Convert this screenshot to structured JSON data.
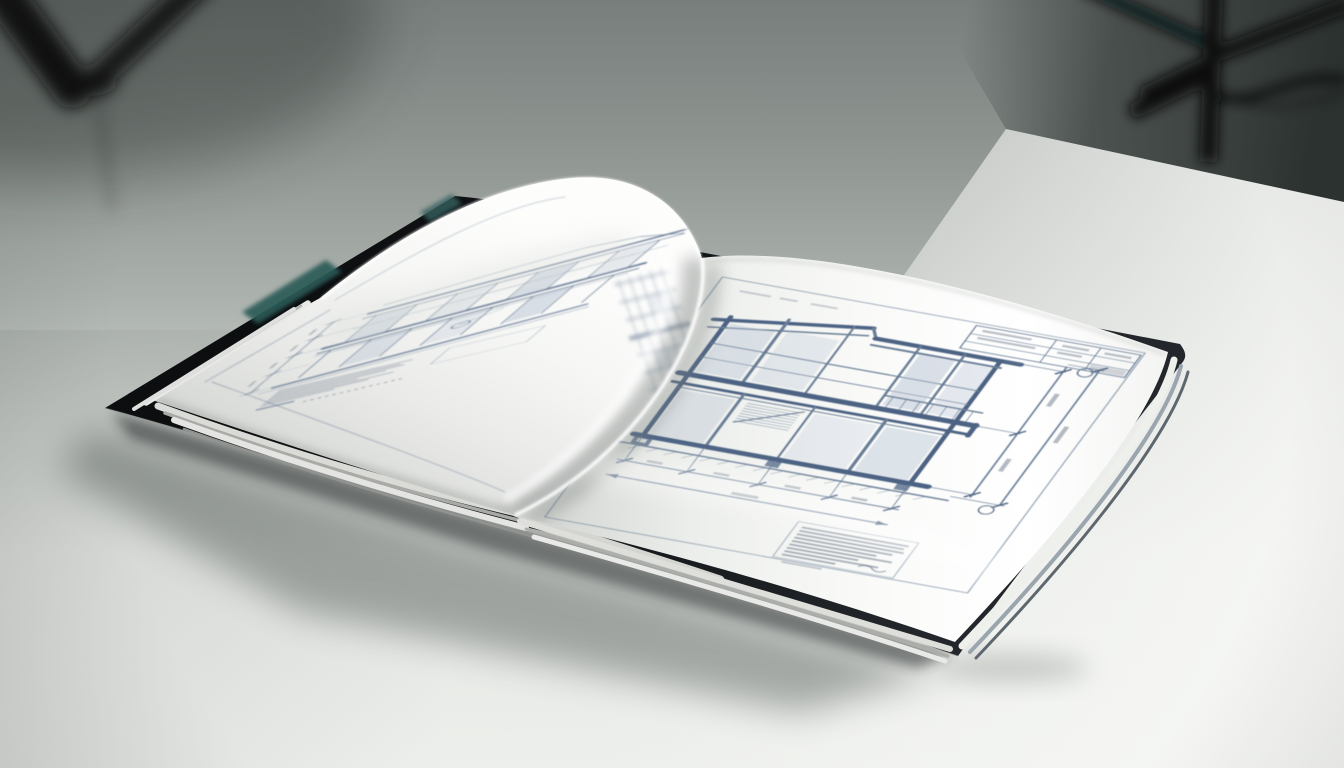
{
  "scene": {
    "type": "photograph",
    "description": "An open hardcover book of architectural blueprint drawings lies on a white studio table, with out-of-focus black tripod light stands against a gray backdrop",
    "background": {
      "backdrop": "seamless gray studio wall, darkest in the upper right corner",
      "tripod_left": "blurred black tripod legs entering the upper left corner",
      "light_stand_right": "blurred black light stand with bracket and trailing cable, upper right",
      "table": "white seamless table surface, brighter toward the lower right"
    },
    "book": {
      "cover": "charcoal-black hardcover, edges visible beyond the page stack",
      "cover_accent": "teal endpaper sliver visible along the upper-left cover edge",
      "pages": "thick white page stack, pages curled upward at the centre gutter",
      "left_page": "multi-storey building facade elevation with glazing grid, slab bands, dimension string and small annotation text (illegible)",
      "right_page": "two-storey building cross-section with floor slab, footings, vertical and horizontal dimension chains, title block and notes block (illegible)"
    },
    "shadow": "soft diffuse shadow cast to the lower left of the book"
  },
  "colors": {
    "backdrop_top": "#787e7c",
    "backdrop_mid": "#aab0ab",
    "backdrop_dark_corner": "#2c3230",
    "table_bright": "#f6f7f5",
    "book_cover": "#101214",
    "cover_accent_teal": "#2c5a57",
    "cover_edge_highlight": "#9aa5ad",
    "page_white": "#fbfcfa",
    "page_shade": "#d7d9d6",
    "blueprint_line": "#6a7e97",
    "blueprint_line_strong": "#4d6384",
    "glazing_fill": "#b7c3d3",
    "annotation_text": "#848d9b",
    "shadow": "#4a514d"
  }
}
